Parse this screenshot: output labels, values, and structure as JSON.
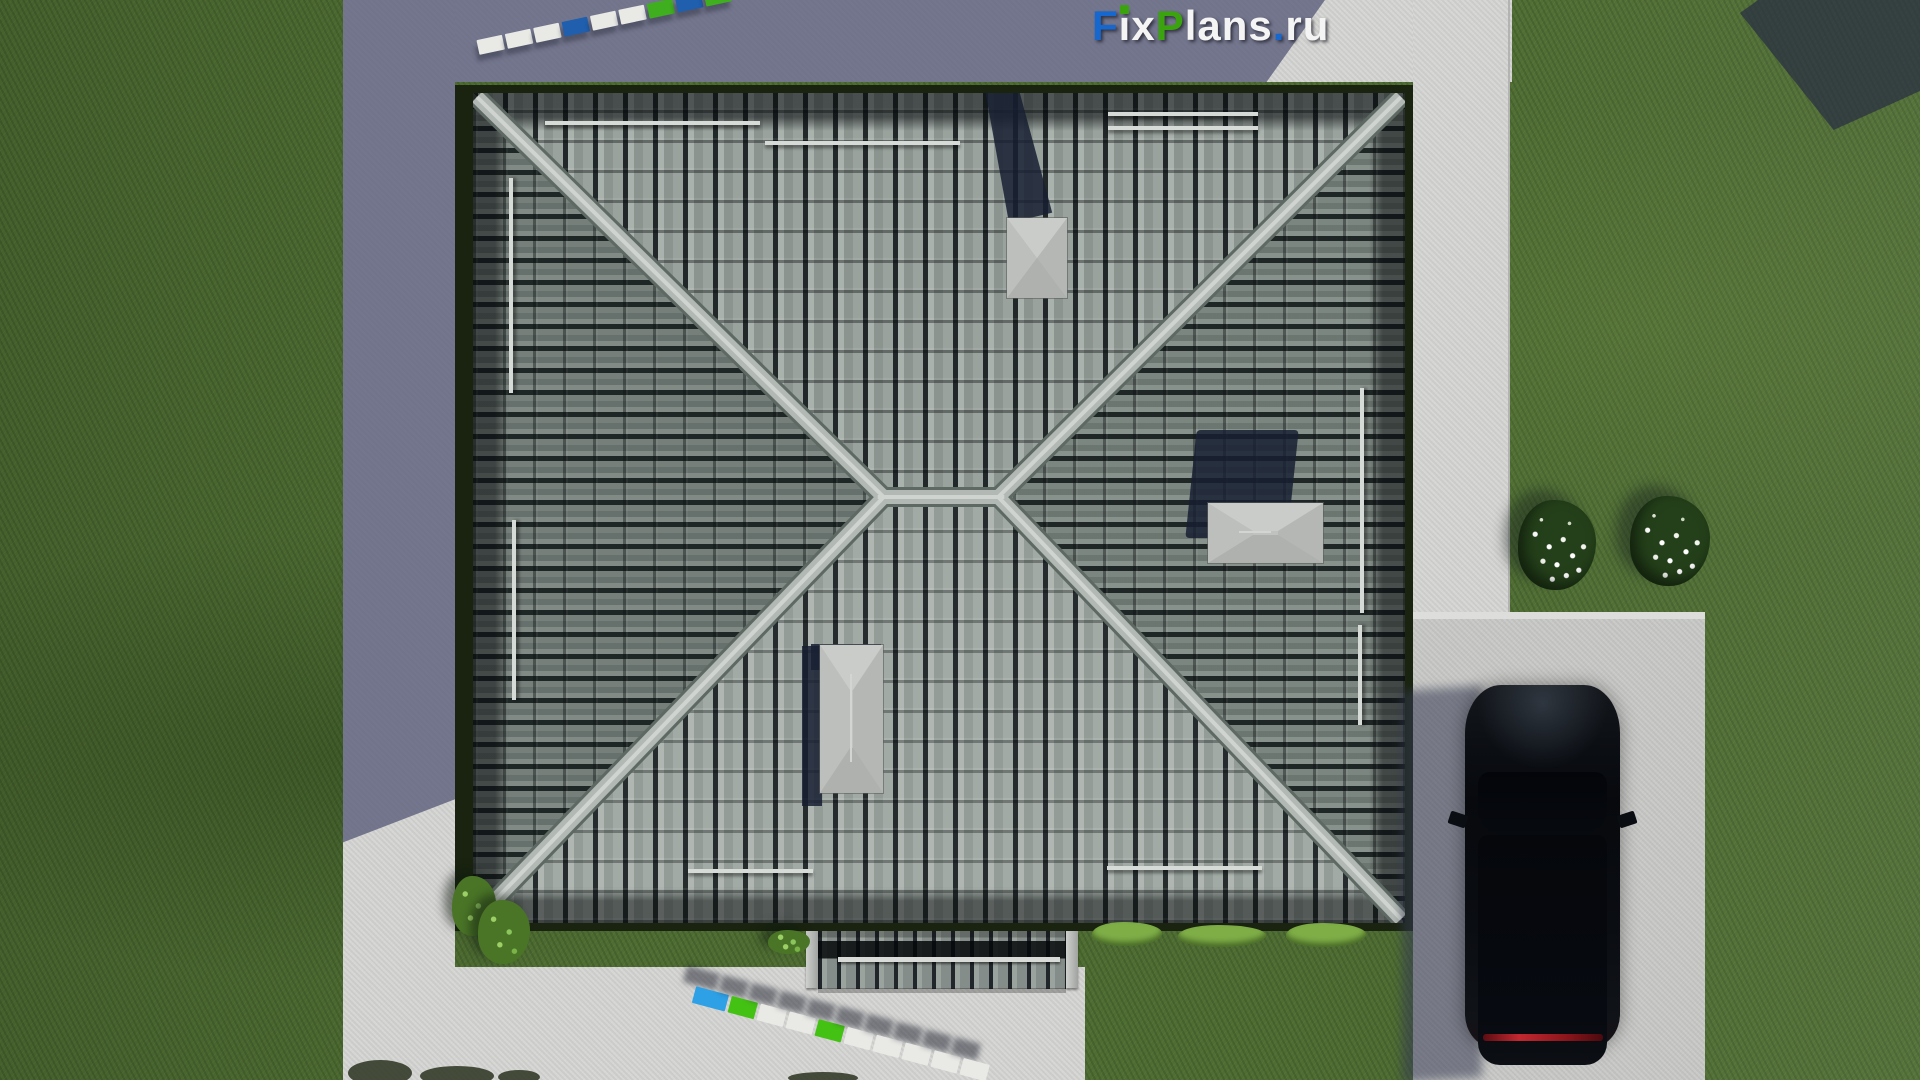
{
  "watermark": {
    "text": "FixPlans.ru",
    "parts": [
      {
        "t": "F",
        "c": "blue"
      },
      {
        "t": "i",
        "c": "white",
        "dot": "green"
      },
      {
        "t": "x",
        "c": "white"
      },
      {
        "t": "P",
        "c": "green"
      },
      {
        "t": "lans",
        "c": "white"
      },
      {
        "t": ".",
        "c": "blue"
      },
      {
        "t": "ru",
        "c": "white"
      }
    ]
  },
  "scene": {
    "view": "top-down 3D render of a house",
    "roof": "square hipped roof with gray barrel tiles, 4 hip ridges, short central ridge, 3 light-gray chimney caps, snow-guard rails",
    "grounds": [
      "lawn",
      "concrete walkways on top and left",
      "concrete apron on right",
      "driveway bottom-right"
    ],
    "objects": [
      "black SUV parked on driveway",
      "two white flower bushes",
      "green shrubs at roof corners",
      "porch canopy with two posts",
      "two segmented surveyor staffs"
    ]
  },
  "surveyor_staffs": {
    "top_segments": [
      "white",
      "white",
      "white",
      "blue",
      "white",
      "white",
      "green",
      "blue",
      "green"
    ],
    "bottom_segments": [
      "blue2",
      "green2",
      "white",
      "white",
      "green2",
      "white",
      "white",
      "white",
      "white",
      "white"
    ]
  },
  "palette": {
    "grass": "#4e6c33",
    "concrete_sunlit": "#d6d6d4",
    "concrete_shadow": "#7d7f95",
    "driveway": "#c9c9c7",
    "roof_tile_light": "#9aa39e",
    "roof_tile_gap": "#23292b",
    "ridge": "#b3b9b5",
    "hedge_dark": "#19230f",
    "chimney_cap": "#c0c3c0",
    "shadow_navy": "#232c42",
    "car_body": "#0a0d12",
    "car_taillight": "#c22830",
    "staff_white": "#e9eae6",
    "staff_blue": "#1f5fae",
    "staff_bright_blue": "#2ea1e6",
    "staff_green": "#3fae1f",
    "logo_blue": "#1668cf",
    "logo_green": "#3aa30d",
    "logo_white": "#f4f4f4"
  }
}
